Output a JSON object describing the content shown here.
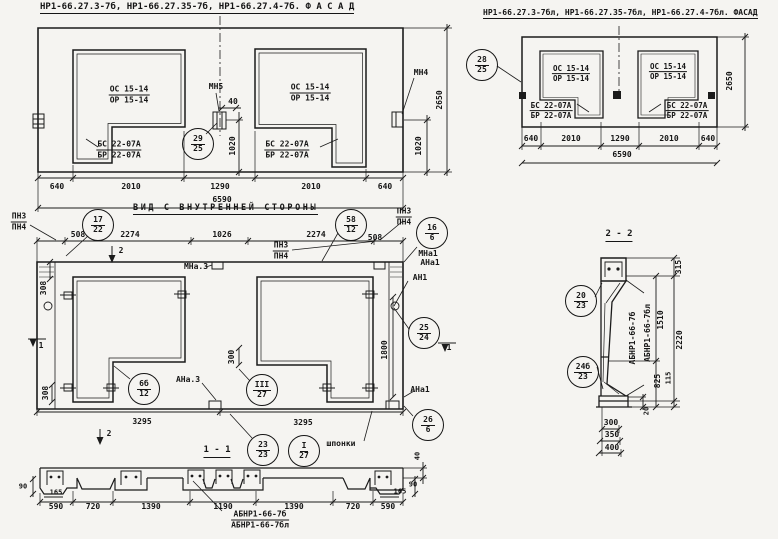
{
  "f1": {
    "title": "НР1-66.27.3-7б, НР1-66.27.35-7б, НР1-66.27.4-7б.  Ф А С А Д",
    "win_a": "ОС 15-14",
    "win_b": "ОР 15-14",
    "sill_a": "БС 22-07А",
    "sill_b": "БР 22-07А",
    "mn5": "МН5",
    "mn4": "МН4",
    "d40": "40",
    "d1020": "1020",
    "d2650": "2650",
    "dims": [
      "640",
      "2010",
      "1290",
      "2010",
      "640"
    ],
    "total": "6590"
  },
  "f2": {
    "title": "НР1-66.27.3-7бл, НР1-66.27.35-7бл, НР1-66.27.4-7бл. ФАСАД",
    "win_a": "ОС 15-14",
    "win_b": "ОР 15-14",
    "sill_a": "БС 22-07А",
    "sill_b": "БР 22-07А",
    "d2650": "2650",
    "dims": [
      "640",
      "2010",
      "1290",
      "2010",
      "640"
    ],
    "total": "6590"
  },
  "iv": {
    "title": "ВИД С ВНУТРЕННЕЙ СТОРОНЫ",
    "pn3": "ПН3",
    "pn4": "ПН4",
    "d508": "508",
    "d2274": "2274",
    "d1026": "1026",
    "d308": "308",
    "d300": "300",
    "d1800": "1800",
    "d3295": "3295",
    "mna1": "МНа1",
    "ana1": "АНа1",
    "an1": "АН1",
    "mna3": "МНа.3",
    "ana3": "АНа.3",
    "shponki": "шпонки",
    "mark1": "1",
    "mark2": "2"
  },
  "s11": {
    "title": "1 - 1",
    "dims": [
      "590",
      "720",
      "1390",
      "1190",
      "1390",
      "720",
      "590"
    ],
    "d90": "90",
    "d165": "165",
    "d40": "40",
    "mark_a": "АБНР1-66-7б",
    "mark_b": "АБНР1-66-7бл"
  },
  "s22": {
    "title": "2 - 2",
    "d315": "315",
    "d1510": "1510",
    "d2220": "2220",
    "d825": "825",
    "d115": "115",
    "d20": "20",
    "d300": "300",
    "d350": "350",
    "d400": "400",
    "mark_a": "АБНР1-66-7б",
    "mark_b": "АБНР1-66-7бл"
  },
  "poz": {
    "c29": [
      "29",
      "25"
    ],
    "c28": [
      "28",
      "25"
    ],
    "c17": [
      "17",
      "22"
    ],
    "c58": [
      "58",
      "12"
    ],
    "c16": [
      "16",
      "6"
    ],
    "c25": [
      "25",
      "24"
    ],
    "c26": [
      "26",
      "6"
    ],
    "c66": [
      "6б",
      "12"
    ],
    "c3r": [
      "III",
      "27"
    ],
    "c23": [
      "23",
      "23"
    ],
    "c1r": [
      "I",
      "27"
    ],
    "c20": [
      "20",
      "23"
    ],
    "c246": [
      "24б",
      "23"
    ]
  }
}
